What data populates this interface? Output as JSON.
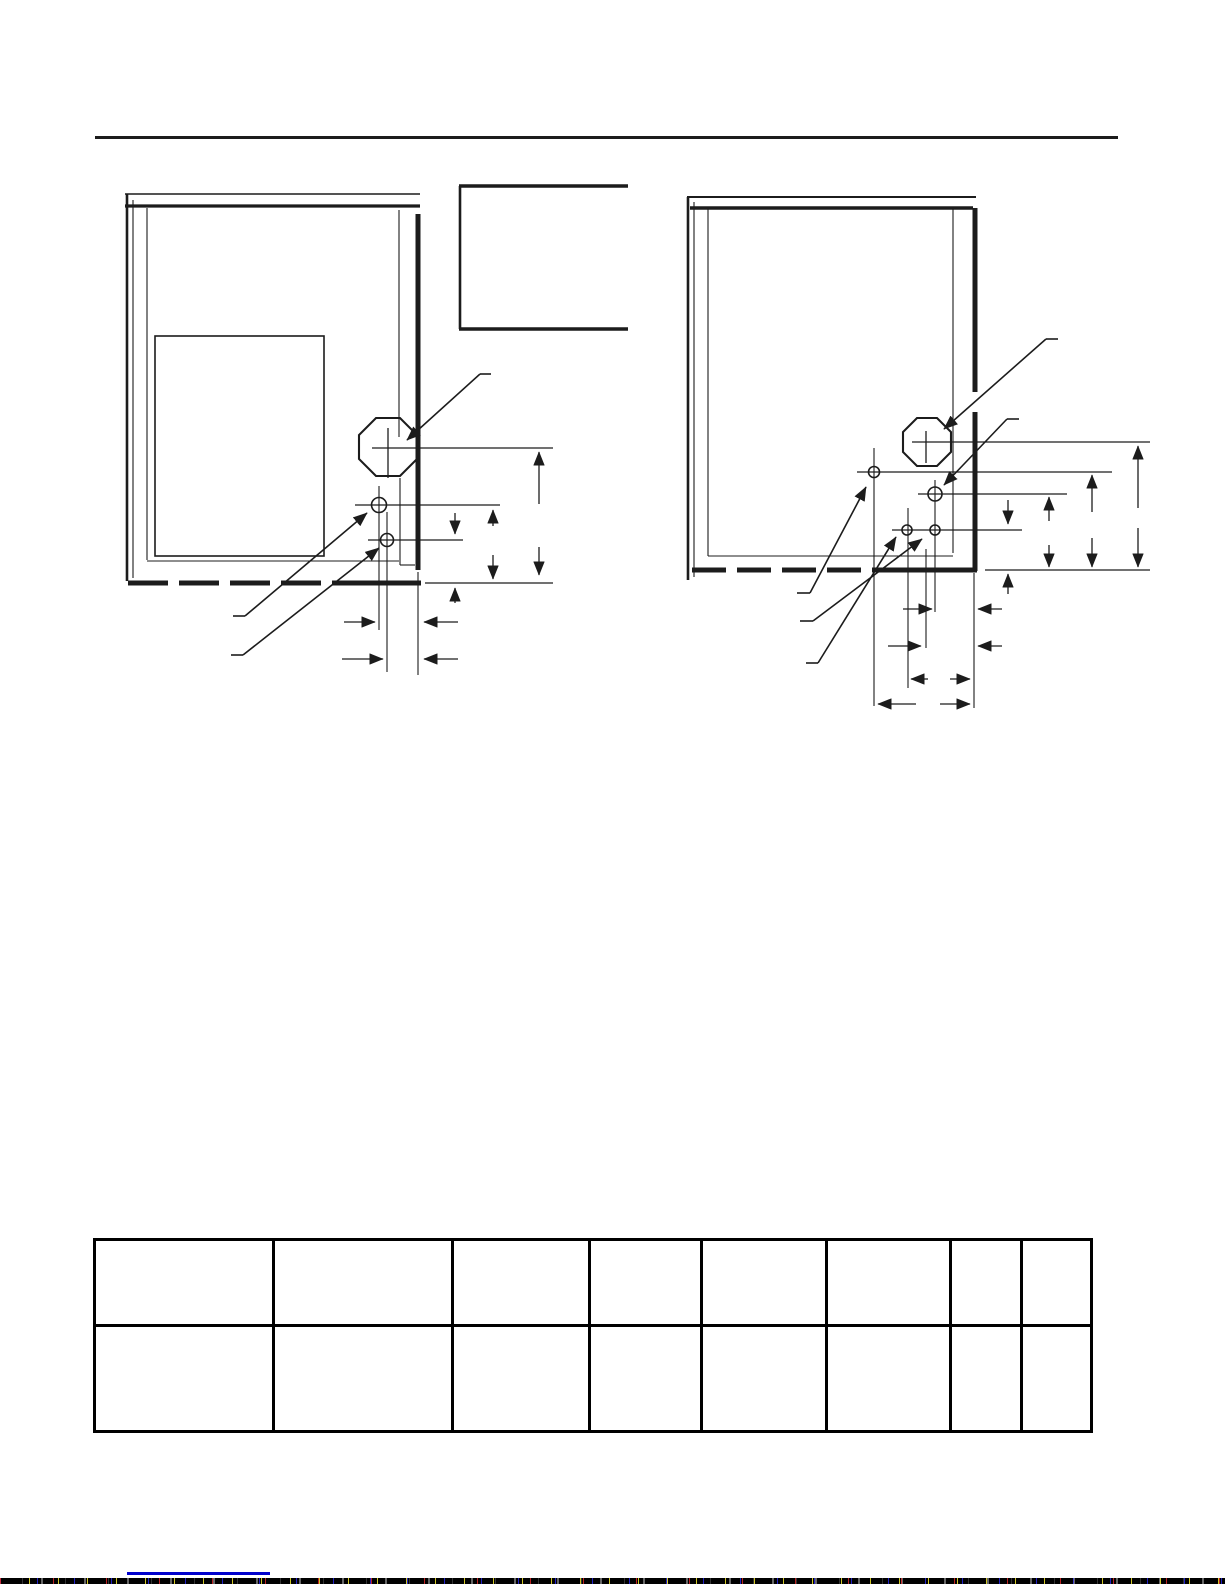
{
  "page": {
    "kind": "scanned manual page",
    "visible_text": ""
  },
  "colors": {
    "paper": "#ffffff",
    "ink": "#1c1c1c",
    "table_border": "#000000",
    "link_blue": "#0000cc"
  },
  "figures": {
    "left_panel": {
      "icon": "furnace-side-panel-with-door-diagram",
      "gas_hole": "octagonal-knockout",
      "small_holes": 2,
      "leader_arrows": 3,
      "dimension_labels_visible": false
    },
    "right_panel": {
      "icon": "furnace-side-panel-diagram",
      "gas_hole": "octagonal-knockout",
      "small_holes": 4,
      "leader_arrows": 5,
      "dimension_labels_visible": false
    }
  },
  "callout_box": {
    "text": ""
  },
  "table": {
    "column_widths_pct": [
      18.0,
      17.9,
      13.8,
      11.2,
      12.5,
      12.5,
      7.1,
      7.0
    ],
    "rows": [
      [
        "",
        "",
        "",
        "",
        "",
        "",
        "",
        ""
      ],
      [
        "",
        "",
        "",
        "",
        "",
        "",
        "",
        ""
      ]
    ]
  },
  "footer": {
    "link_text": ""
  }
}
